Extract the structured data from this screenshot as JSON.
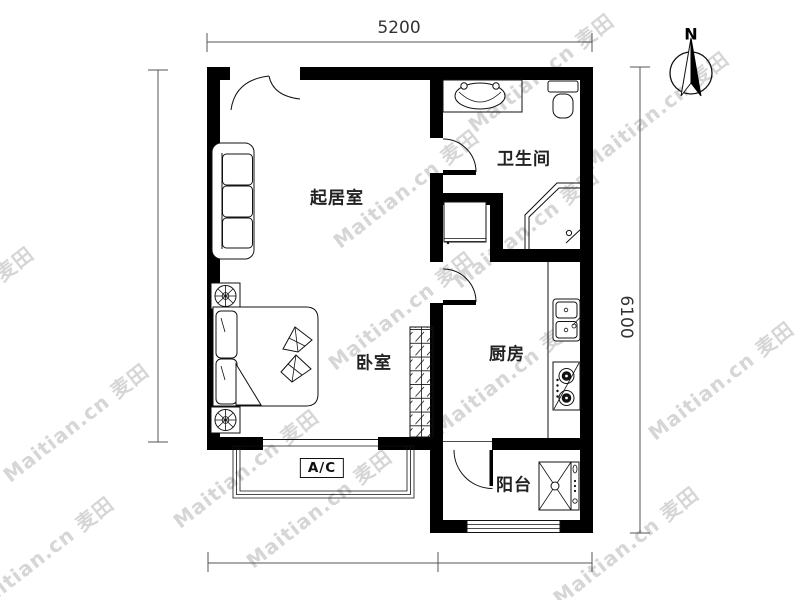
{
  "plan": {
    "rooms": {
      "living_room": {
        "label": "起居室"
      },
      "bedroom": {
        "label": "卧室"
      },
      "bathroom": {
        "label": "卫生间"
      },
      "kitchen": {
        "label": "厨房"
      },
      "balcony": {
        "label": "阳台"
      }
    },
    "annotations": {
      "ac_label": "A/C"
    },
    "dimensions": {
      "width_top": "5200",
      "height_right": "6100"
    },
    "compass": {
      "north_label": "N"
    }
  },
  "watermark": {
    "text": "Maitian.cn 麦田",
    "site": "Maitian.cn",
    "brand": "麦田",
    "color": "#d6d6d6"
  },
  "colors": {
    "background": "#ffffff",
    "wall": "#000000",
    "fixture_line": "#111111",
    "dimension_line": "#555555",
    "label_text": "#222222"
  }
}
